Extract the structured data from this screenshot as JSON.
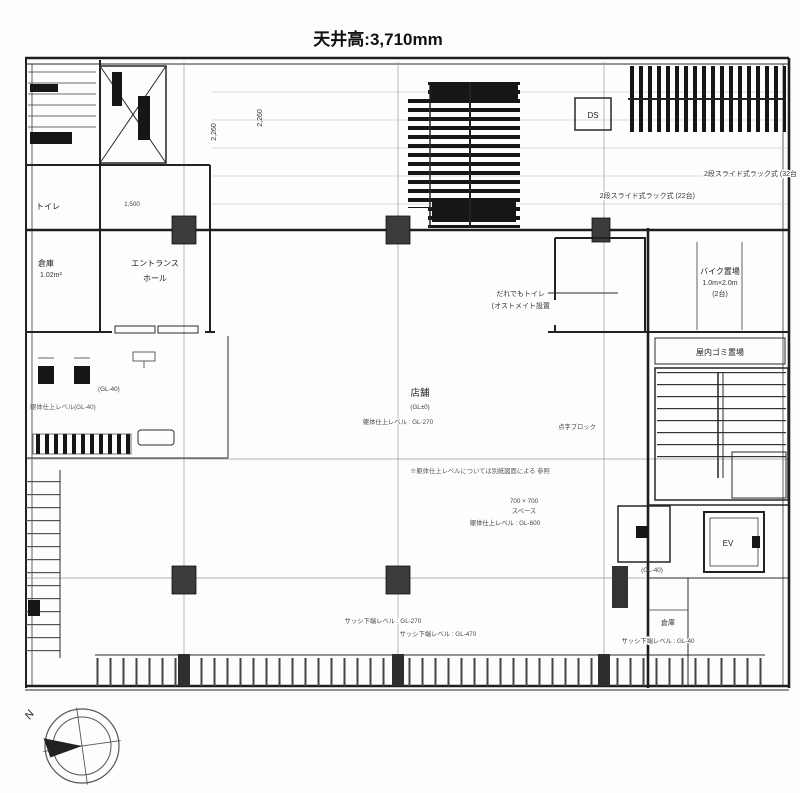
{
  "title": "天井高:3,710mm",
  "colors": {
    "line": "#222222",
    "grid": "#999999",
    "column_fill": "#3b3b3b"
  },
  "labels": {
    "rack_line1": "2段スライド式ラック式 (32台",
    "rack_line2": "2段スライド式ラック式 (22台)",
    "ds": "DS",
    "toilet": "トイレ",
    "storage": "倉庫",
    "storage_area": "1.02m²",
    "entrance1": "エントランス",
    "entrance2": "ホール",
    "dim_a": "2,260",
    "dim_b": "2,260",
    "dim_c": "1,500",
    "accessible1": "だれでもトイレ",
    "accessible2": "(オストメイト設置",
    "bike1": "バイク置場",
    "bike2": "1.0m×2.0m",
    "bike3": "(2台)",
    "indoor_trash": "屋内ゴミ置場",
    "shop": "店舗",
    "shop_gl": "(GL±0)",
    "shop_slab": "躯体仕上レベル : GL-270",
    "braille": "点字ブロック",
    "note": "※躯体仕上レベルについては別紙図面による 参照",
    "space_dim": "700 × 700",
    "space": "スペース",
    "space_slab": "躯体仕上レベル : GL-600",
    "sash270": "サッシ下端レベル : GL-270",
    "sash470": "サッシ下端レベル : GL-470",
    "storage_small": "倉庫",
    "sash40": "サッシ下端レベル : GL-40",
    "gl40": "(GL-40)",
    "gl40b": "(GL-40)",
    "fixture_note": "躯体仕上レベル(GL-40)",
    "ev": "EV"
  },
  "compass": {
    "north": "N"
  }
}
